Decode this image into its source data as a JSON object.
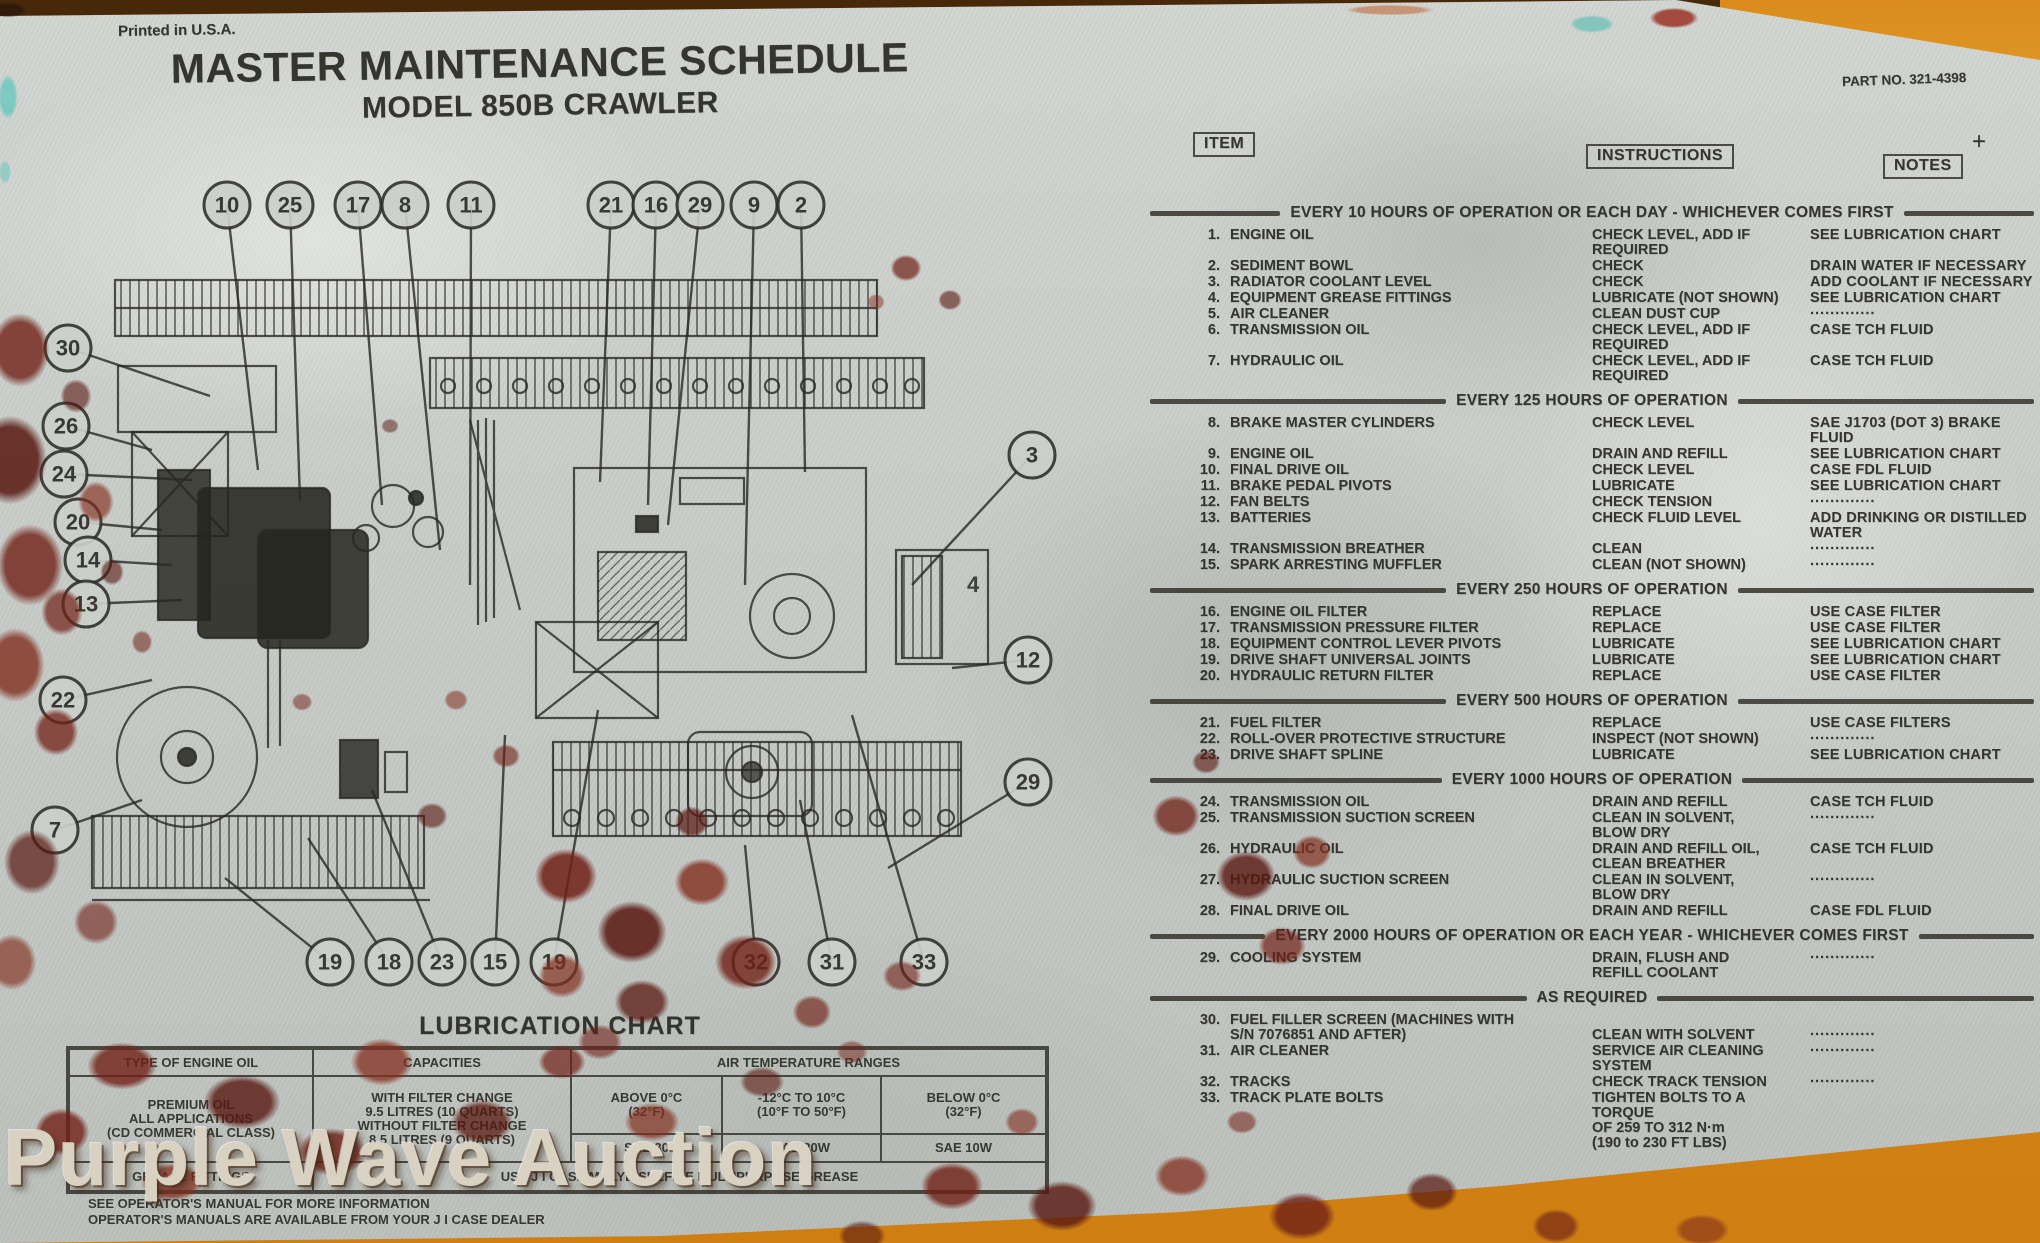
{
  "meta": {
    "printed": "Printed in U.S.A.",
    "part_no": "PART NO. 321-4398",
    "cross": "+",
    "plate_code": "770739C",
    "watermark": "Purple Wave Auction"
  },
  "title": {
    "line1": "MASTER MAINTENANCE SCHEDULE",
    "line2": "MODEL 850B CRAWLER"
  },
  "schedule": {
    "headers": {
      "item": "ITEM",
      "instructions": "INSTRUCTIONS",
      "notes": "NOTES"
    },
    "sections": [
      {
        "title": "EVERY 10 HOURS OF OPERATION OR EACH DAY - WHICHEVER COMES FIRST",
        "rows": [
          {
            "num": "1.",
            "item": "ENGINE OIL",
            "instructions": "CHECK LEVEL, ADD IF\nREQUIRED",
            "notes": "SEE LUBRICATION CHART"
          },
          {
            "num": "2.",
            "item": "SEDIMENT BOWL",
            "instructions": "CHECK",
            "notes": "DRAIN WATER IF NECESSARY"
          },
          {
            "num": "3.",
            "item": "RADIATOR COOLANT LEVEL",
            "instructions": "CHECK",
            "notes": "ADD COOLANT IF NECESSARY"
          },
          {
            "num": "4.",
            "item": "EQUIPMENT GREASE FITTINGS",
            "instructions": "LUBRICATE (NOT SHOWN)",
            "notes": "SEE LUBRICATION CHART"
          },
          {
            "num": "5.",
            "item": "AIR CLEANER",
            "instructions": "CLEAN DUST CUP",
            "notes": "·············"
          },
          {
            "num": "6.",
            "item": "TRANSMISSION OIL",
            "instructions": "CHECK LEVEL, ADD IF\nREQUIRED",
            "notes": "CASE TCH FLUID"
          },
          {
            "num": "7.",
            "item": "HYDRAULIC OIL",
            "instructions": "CHECK LEVEL, ADD IF\nREQUIRED",
            "notes": "CASE TCH FLUID"
          }
        ]
      },
      {
        "title": "EVERY 125 HOURS OF OPERATION",
        "rows": [
          {
            "num": "8.",
            "item": "BRAKE MASTER CYLINDERS",
            "instructions": "CHECK LEVEL",
            "notes": "SAE J1703 (DOT 3) BRAKE FLUID"
          },
          {
            "num": "9.",
            "item": "ENGINE OIL",
            "instructions": "DRAIN AND REFILL",
            "notes": "SEE LUBRICATION CHART"
          },
          {
            "num": "10.",
            "item": "FINAL DRIVE OIL",
            "instructions": "CHECK LEVEL",
            "notes": "CASE FDL FLUID"
          },
          {
            "num": "11.",
            "item": "BRAKE PEDAL PIVOTS",
            "instructions": "LUBRICATE",
            "notes": "SEE LUBRICATION CHART"
          },
          {
            "num": "12.",
            "item": "FAN BELTS",
            "instructions": "CHECK TENSION",
            "notes": "·············"
          },
          {
            "num": "13.",
            "item": "BATTERIES",
            "instructions": "CHECK FLUID LEVEL",
            "notes": "ADD DRINKING OR DISTILLED\nWATER"
          },
          {
            "num": "14.",
            "item": "TRANSMISSION BREATHER",
            "instructions": "CLEAN",
            "notes": "·············"
          },
          {
            "num": "15.",
            "item": "SPARK ARRESTING MUFFLER",
            "instructions": "CLEAN (NOT SHOWN)",
            "notes": "·············"
          }
        ]
      },
      {
        "title": "EVERY 250 HOURS OF OPERATION",
        "rows": [
          {
            "num": "16.",
            "item": "ENGINE OIL FILTER",
            "instructions": "REPLACE",
            "notes": "USE CASE FILTER"
          },
          {
            "num": "17.",
            "item": "TRANSMISSION PRESSURE FILTER",
            "instructions": "REPLACE",
            "notes": "USE CASE FILTER"
          },
          {
            "num": "18.",
            "item": "EQUIPMENT CONTROL LEVER PIVOTS",
            "instructions": "LUBRICATE",
            "notes": "SEE LUBRICATION CHART"
          },
          {
            "num": "19.",
            "item": "DRIVE SHAFT UNIVERSAL JOINTS",
            "instructions": "LUBRICATE",
            "notes": "SEE LUBRICATION CHART"
          },
          {
            "num": "20.",
            "item": "HYDRAULIC RETURN FILTER",
            "instructions": "REPLACE",
            "notes": "USE CASE FILTER"
          }
        ]
      },
      {
        "title": "EVERY 500 HOURS OF OPERATION",
        "rows": [
          {
            "num": "21.",
            "item": "FUEL FILTER",
            "instructions": "REPLACE",
            "notes": "USE CASE FILTERS"
          },
          {
            "num": "22.",
            "item": "ROLL-OVER PROTECTIVE STRUCTURE",
            "instructions": "INSPECT (NOT SHOWN)",
            "notes": "·············"
          },
          {
            "num": "23.",
            "item": "DRIVE SHAFT SPLINE",
            "instructions": "LUBRICATE",
            "notes": "SEE LUBRICATION CHART"
          }
        ]
      },
      {
        "title": "EVERY 1000 HOURS OF OPERATION",
        "rows": [
          {
            "num": "24.",
            "item": "TRANSMISSION OIL",
            "instructions": "DRAIN AND REFILL",
            "notes": "CASE TCH FLUID"
          },
          {
            "num": "25.",
            "item": "TRANSMISSION SUCTION SCREEN",
            "instructions": "CLEAN IN SOLVENT,\nBLOW DRY",
            "notes": "·············"
          },
          {
            "num": "26.",
            "item": "HYDRAULIC OIL",
            "instructions": "DRAIN AND REFILL OIL,\nCLEAN BREATHER",
            "notes": "CASE TCH FLUID"
          },
          {
            "num": "27.",
            "item": "HYDRAULIC SUCTION SCREEN",
            "instructions": "CLEAN IN SOLVENT,\nBLOW DRY",
            "notes": "·············"
          },
          {
            "num": "28.",
            "item": "FINAL DRIVE OIL",
            "instructions": "DRAIN AND REFILL",
            "notes": "CASE FDL FLUID"
          }
        ]
      },
      {
        "title": "EVERY 2000 HOURS OF OPERATION OR EACH YEAR - WHICHEVER COMES FIRST",
        "rows": [
          {
            "num": "29.",
            "item": "COOLING SYSTEM",
            "instructions": "DRAIN, FLUSH AND\nREFILL COOLANT",
            "notes": "·············"
          }
        ]
      },
      {
        "title": "AS REQUIRED",
        "rows": [
          {
            "num": "30.",
            "item": "FUEL FILLER SCREEN (MACHINES WITH\nS/N 7076851 AND AFTER)",
            "instructions": "\nCLEAN WITH SOLVENT",
            "notes": "\n·············"
          },
          {
            "num": "31.",
            "item": "AIR CLEANER",
            "instructions": "SERVICE AIR CLEANING\nSYSTEM",
            "notes": "·············"
          },
          {
            "num": "32.",
            "item": "TRACKS",
            "instructions": "CHECK TRACK TENSION",
            "notes": "·············"
          },
          {
            "num": "33.",
            "item": "TRACK PLATE BOLTS",
            "instructions": "TIGHTEN BOLTS TO A TORQUE\nOF 259 TO 312 N·m\n(190 to 230 FT LBS)",
            "notes": ""
          }
        ]
      }
    ]
  },
  "lubrication": {
    "title": "LUBRICATION CHART",
    "col_headers": [
      "TYPE OF ENGINE OIL",
      "CAPACITIES",
      "AIR TEMPERATURE RANGES"
    ],
    "oil_type": "PREMIUM OIL\nALL APPLICATIONS\n(CD COMMERCIAL CLASS)",
    "capacities": "WITH FILTER CHANGE\n9.5 LITRES (10 QUARTS)\nWITHOUT FILTER CHANGE\n8.5 LITRES (9 QUARTS)",
    "temp_headers": [
      "ABOVE 0°C\n(32°F)",
      "-12°C TO 10°C\n(10°F TO 50°F)",
      "BELOW 0°C\n(32°F)"
    ],
    "sae_values": [
      "SAE 30",
      "SAE 20W",
      "SAE 10W"
    ],
    "grease_label": "GREASE FITTINGS",
    "grease_value": "USE J I CASE MOLYDISULFIDE MULTIPURPOSE GREASE",
    "footer": [
      "SEE OPERATOR'S MANUAL FOR MORE INFORMATION",
      "OPERATOR'S MANUALS ARE AVAILABLE FROM YOUR J I CASE DEALER"
    ]
  },
  "diagram": {
    "inline_label": "4",
    "callouts": {
      "top": [
        "10",
        "25",
        "17",
        "8",
        "11",
        "21",
        "16",
        "29",
        "9",
        "2"
      ],
      "left": [
        "30",
        "26",
        "24",
        "20",
        "14",
        "13",
        "22",
        "7"
      ],
      "right": [
        "3",
        "12",
        "29"
      ],
      "bottom": [
        "19",
        "18",
        "23",
        "15",
        "19",
        "32",
        "31",
        "33"
      ]
    }
  }
}
